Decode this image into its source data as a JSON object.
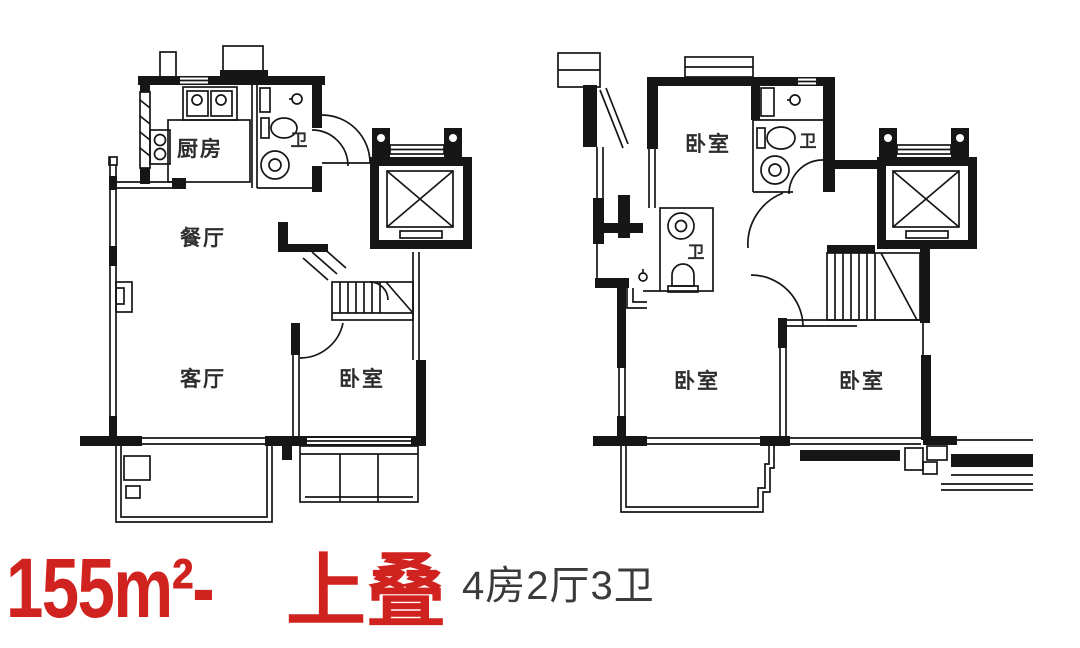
{
  "caption": {
    "area": "155m²-",
    "type": "上叠",
    "layout": "4房2厅3卫"
  },
  "plans": {
    "left": {
      "kitchen": "厨房",
      "bathroom": "卫",
      "dining": "餐厅",
      "living": "客厅",
      "bedroom": "卧室"
    },
    "right": {
      "bedroom_top": "卧室",
      "bathroom_top": "卫",
      "bathroom_mid": "卫",
      "bedroom_left": "卧室",
      "bedroom_right": "卧室"
    }
  },
  "colors": {
    "accent": "#d0221f",
    "ink": "#161616",
    "caption_text": "#3b3b3b",
    "background": "#ffffff"
  }
}
